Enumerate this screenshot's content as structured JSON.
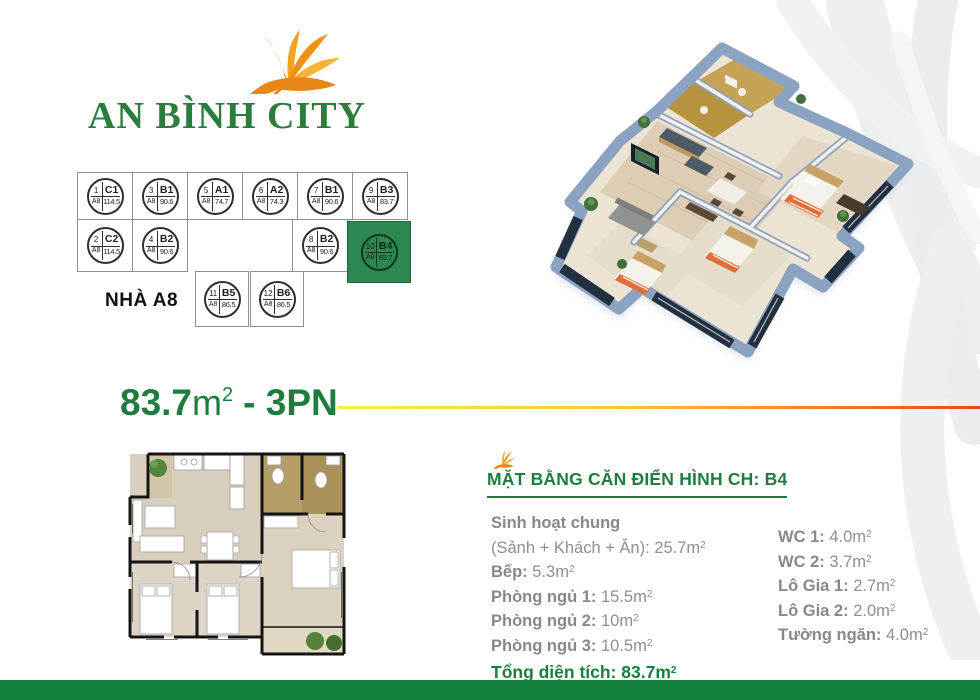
{
  "logo": {
    "text": "AN BÌNH CITY"
  },
  "building": {
    "name": "NHÀ A8",
    "units": [
      {
        "no": "1",
        "code": "C1",
        "block": "A8",
        "area": "114.5"
      },
      {
        "no": "3",
        "code": "B1",
        "block": "A8",
        "area": "90.6"
      },
      {
        "no": "5",
        "code": "A1",
        "block": "A8",
        "area": "74.7"
      },
      {
        "no": "6",
        "code": "A2",
        "block": "A8",
        "area": "74.3"
      },
      {
        "no": "7",
        "code": "B1",
        "block": "A8",
        "area": "90.6"
      },
      {
        "no": "9",
        "code": "B3",
        "block": "A8",
        "area": "83.7"
      },
      {
        "no": "2",
        "code": "C2",
        "block": "A8",
        "area": "114.5"
      },
      {
        "no": "4",
        "code": "B2",
        "block": "A8",
        "area": "90.6"
      },
      {
        "no": "8",
        "code": "B2",
        "block": "A8",
        "area": "90.6"
      },
      {
        "no": "10",
        "code": "B4",
        "block": "A8",
        "area": "83.7",
        "highlighted": true
      },
      {
        "no": "11",
        "code": "B5",
        "block": "A8",
        "area": "86.5"
      },
      {
        "no": "12",
        "code": "B6",
        "block": "A8",
        "area": "86.5"
      }
    ]
  },
  "title": {
    "area": "83.7",
    "unit": "m",
    "sup": "2",
    "suffix": "- 3PN"
  },
  "units_text": {
    "m": "m",
    "sup": "2"
  },
  "details": {
    "heading": "MẶT BẰNG CĂN ĐIỂN HÌNH CH: B4",
    "left": [
      {
        "label": "Sinh hoạt chung"
      },
      {
        "label": "(Sảnh + Khách + Ăn):",
        "value": "25.7"
      },
      {
        "label": "Bếp:",
        "value": "5.3"
      },
      {
        "label": "Phòng ngủ 1:",
        "value": "15.5"
      },
      {
        "label": "Phòng ngủ 2:",
        "value": "10"
      },
      {
        "label": "Phòng ngủ 3:",
        "value": "10.5"
      }
    ],
    "total": {
      "label": "Tổng diện tích:",
      "value": "83.7"
    },
    "right": [
      {
        "label": "WC 1:",
        "value": "4.0"
      },
      {
        "label": "WC 2:",
        "value": "3.7"
      },
      {
        "label": "Lô Gia 1:",
        "value": "2.7"
      },
      {
        "label": "Lô Gia 2:",
        "value": "2.0"
      },
      {
        "label": "Tường ngăn:",
        "value": "4.0"
      }
    ]
  },
  "colors": {
    "brand_green": "#1e7c3e",
    "logo_green": "#2b7d3e",
    "highlight_unit_green": "#2d8751",
    "footer_green": "#15813e",
    "gradient_start": "#f9ed4e",
    "gradient_mid": "#f4c63b",
    "gradient_end": "#e2492f",
    "detail_gray": "#8f8f91",
    "flower_orange": "#f29111"
  }
}
